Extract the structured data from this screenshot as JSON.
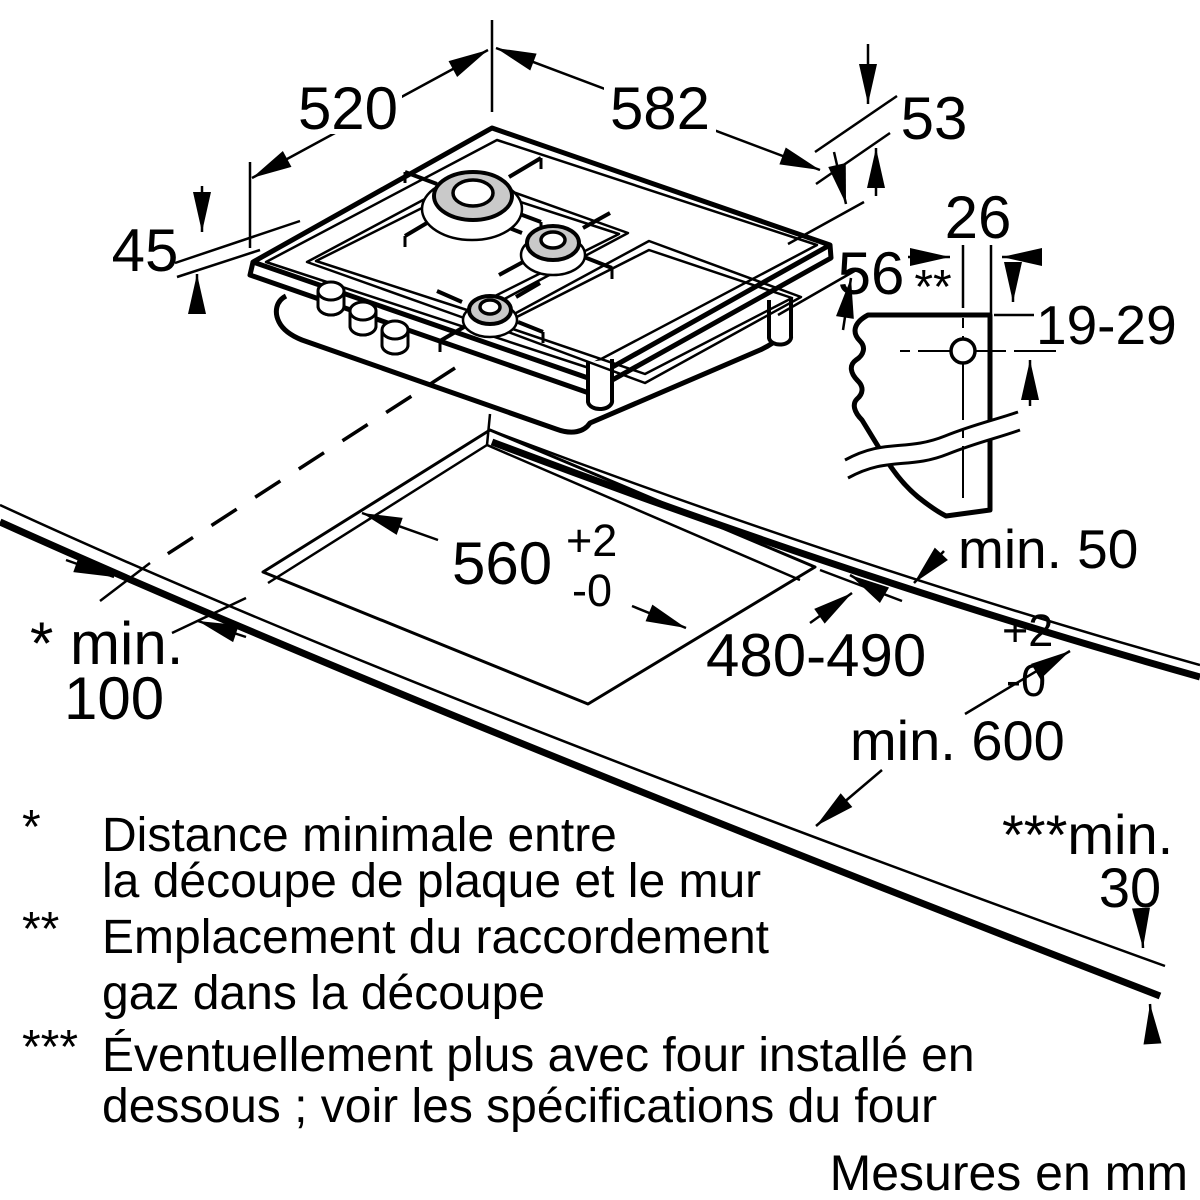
{
  "diagram": {
    "kind": "gas-hob-installation-dimensions",
    "units_note": "Mesures en mm",
    "hob": {
      "depth_label": "520",
      "width_label": "582",
      "height_total_label": "53",
      "height_front_label": "45",
      "height_body_label": "56",
      "gas_marker": "**"
    },
    "gas_connection": {
      "offset_label": "26",
      "depth_range_label": "19-29"
    },
    "cutout": {
      "width_value": "560",
      "width_tol_sup": "+2",
      "width_tol_sub": "-0",
      "depth_value": "480-490",
      "depth_tol_sup": "+2",
      "depth_tol_sub": "-0"
    },
    "clearances": {
      "wall_side": "min. 50",
      "front_label": "* min.",
      "front_value": "100",
      "depth_label": "min. 600",
      "thickness_label": "***min.",
      "thickness_value": "30"
    },
    "footnotes": [
      {
        "marker": "*",
        "line1": "Distance minimale entre",
        "line2": "la découpe de plaque et le mur"
      },
      {
        "marker": "**",
        "line1": "Emplacement du raccordement",
        "line2": "gaz dans la découpe"
      },
      {
        "marker": "***",
        "line1": "Éventuellement plus avec four installé en",
        "line2": "dessous ; voir les spécifications du four"
      }
    ]
  }
}
